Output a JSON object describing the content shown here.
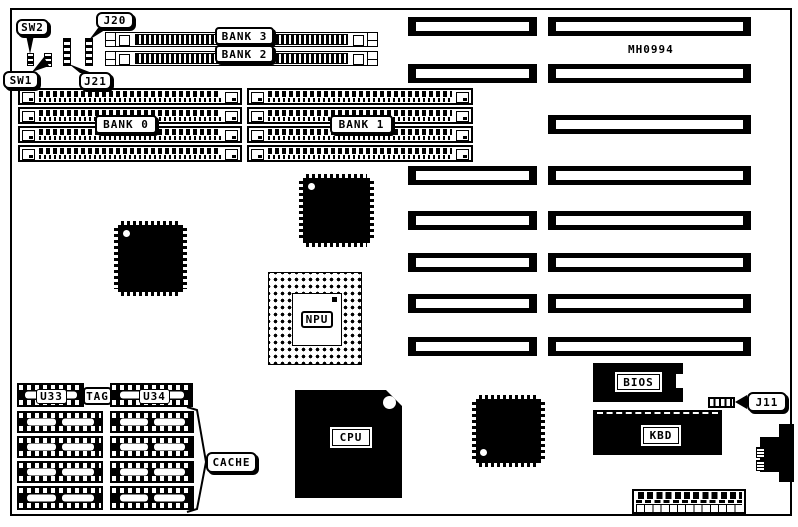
{
  "board": {
    "id_label": "MH0994",
    "callouts": {
      "sw2": "SW2",
      "sw1": "SW1",
      "j20": "J20",
      "j21": "J21",
      "j11": "J11",
      "cache": "CACHE"
    },
    "memory_banks": {
      "bank0": "BANK 0",
      "bank1": "BANK 1",
      "bank2": "BANK 2",
      "bank3": "BANK 3"
    },
    "chips": {
      "npu": "NPU",
      "cpu": "CPU",
      "bios": "BIOS",
      "kbd": "KBD"
    },
    "cache_labels": {
      "u33": "U33",
      "tag": "TAG",
      "u34": "U34"
    }
  }
}
